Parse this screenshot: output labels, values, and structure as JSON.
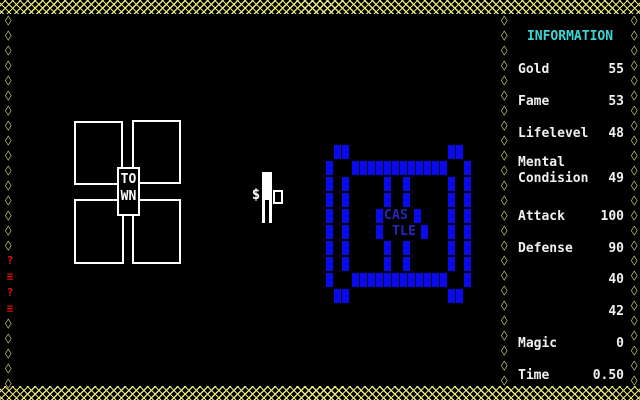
{
  "decor": {
    "border_color": "#e6e67c",
    "red_marker_text": "?\n≡\n?\n≡"
  },
  "town": {
    "label": "TO\nWN"
  },
  "player": {
    "money_symbol": "$"
  },
  "castle": {
    "label_top": "CAS",
    "label_bottom": "TLE",
    "block_color": "#0a0af0",
    "label_color": "#2626c0",
    "rows": [
      {
        "y": 145,
        "xs": [
          334,
          342,
          448,
          456
        ]
      },
      {
        "y": 161,
        "xs": [
          326,
          352,
          360,
          368,
          376,
          384,
          392,
          400,
          408,
          416,
          424,
          432,
          440,
          464
        ]
      },
      {
        "y": 177,
        "xs": [
          326,
          342,
          384,
          403,
          448,
          464
        ]
      },
      {
        "y": 193,
        "xs": [
          326,
          342,
          384,
          403,
          448,
          464
        ]
      },
      {
        "y": 209,
        "xs": [
          326,
          342,
          376,
          414,
          448,
          464
        ]
      },
      {
        "y": 225,
        "xs": [
          326,
          342,
          376,
          421,
          448,
          464
        ]
      },
      {
        "y": 241,
        "xs": [
          326,
          342,
          384,
          403,
          448,
          464
        ]
      },
      {
        "y": 257,
        "xs": [
          326,
          342,
          384,
          403,
          448,
          464
        ]
      },
      {
        "y": 273,
        "xs": [
          326,
          352,
          360,
          368,
          376,
          384,
          392,
          400,
          408,
          416,
          424,
          432,
          440,
          464
        ]
      },
      {
        "y": 289,
        "xs": [
          334,
          342,
          448,
          456
        ]
      }
    ]
  },
  "panel": {
    "title": "INFORMATION",
    "title_color": "#3cd5d5",
    "stats": [
      {
        "label": "Gold",
        "value": "55"
      },
      {
        "label": "Fame",
        "value": "53"
      },
      {
        "label": "Lifelevel",
        "value": "48"
      },
      {
        "label": "Mental\nCondision",
        "value": "49"
      },
      {
        "label": "Attack",
        "value": "100"
      },
      {
        "label": "Defense",
        "value": "90"
      },
      {
        "label": "",
        "value": "40"
      },
      {
        "label": "",
        "value": "42"
      },
      {
        "label": "Magic",
        "value": "0"
      },
      {
        "label": "Time",
        "value": "0.50"
      }
    ]
  }
}
